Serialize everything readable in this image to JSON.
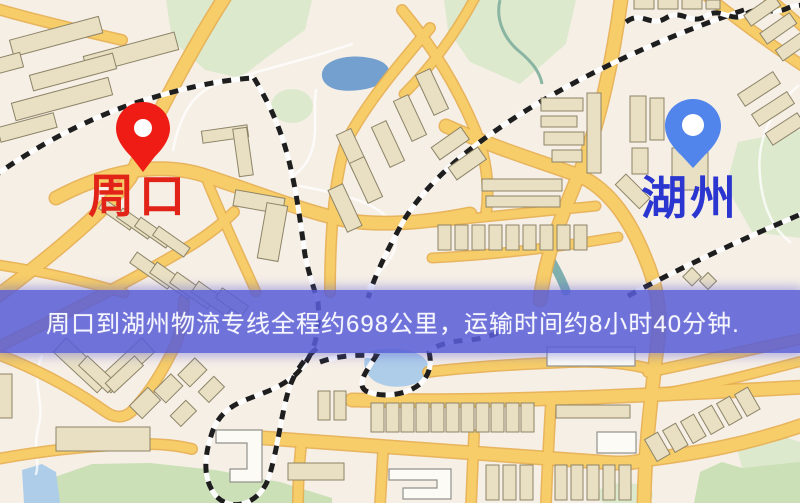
{
  "map": {
    "origin": {
      "label": "周口",
      "pin": "red-location-pin",
      "pin_color": "#ee1c15",
      "label_color": "#e22418"
    },
    "destination": {
      "label": "湖州",
      "pin": "blue-location-pin",
      "pin_color": "#5285ec",
      "label_color": "#2b35cf"
    },
    "palette": {
      "background": "#f6efe6",
      "road_core": "#f6cd68",
      "road_casing": "#e7ad4e",
      "park": "#dde9cd",
      "water": "#74a0cf",
      "building": "#e9e0c4",
      "railway": "#1e1e1e"
    }
  },
  "banner": {
    "text": "周口到湖州物流专线全程约698公里，运输时间约8小时40分钟.",
    "background": "#585dd6",
    "text_color": "#ffffff",
    "route": {
      "origin": "周口",
      "destination": "湖州",
      "distance_km": "698",
      "duration": "8小时40分钟"
    }
  }
}
